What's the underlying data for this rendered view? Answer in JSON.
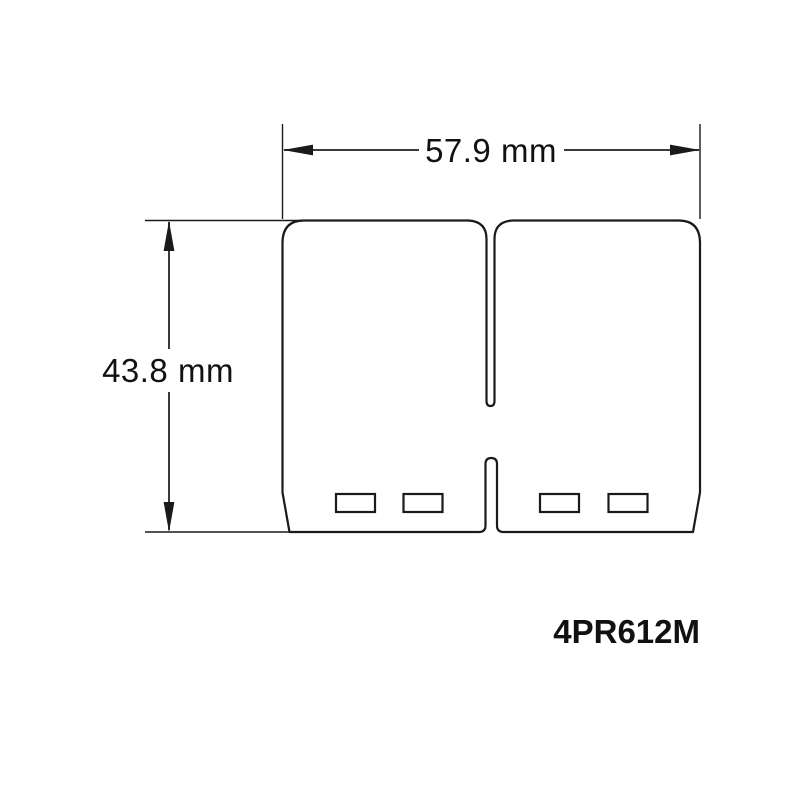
{
  "diagram": {
    "kind": "technical-dimension-drawing",
    "part_number": "4PR612M",
    "dimensions": {
      "width": {
        "label": "57.9 mm",
        "value_mm": 57.9,
        "unit": "mm"
      },
      "height": {
        "label": "43.8 mm",
        "value_mm": 43.8,
        "unit": "mm"
      }
    },
    "colors": {
      "background": "#ffffff",
      "outline": "#1a1a1a",
      "dimension_line": "#3a3a3a",
      "text": "#111111"
    }
  }
}
